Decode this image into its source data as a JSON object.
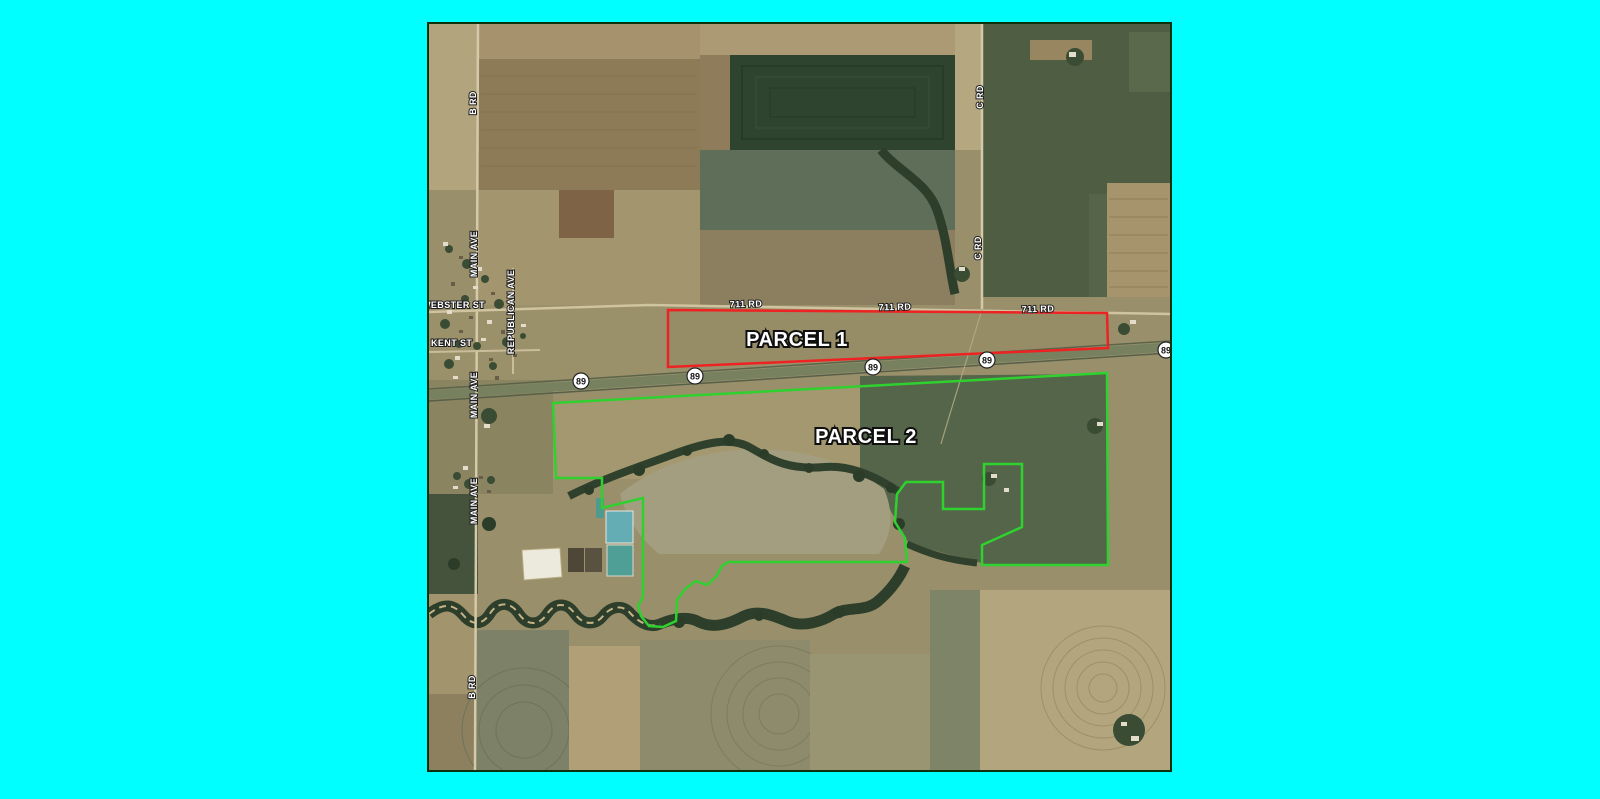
{
  "page": {
    "background_color": "#00ffff"
  },
  "map": {
    "border_color": "#0d300d",
    "parcels": [
      {
        "label": "PARCEL 1",
        "outline_color": "#ee2222"
      },
      {
        "label": "PARCEL 2",
        "outline_color": "#2fd12f"
      }
    ],
    "shields": [
      {
        "number": "89"
      },
      {
        "number": "89"
      },
      {
        "number": "89"
      },
      {
        "number": "89"
      },
      {
        "number": "89"
      }
    ],
    "road_labels": [
      {
        "text": "B RD"
      },
      {
        "text": "MAIN AVE"
      },
      {
        "text": "WEBSTER ST"
      },
      {
        "text": "REPUBLICAN AVE"
      },
      {
        "text": "KENT ST"
      },
      {
        "text": "MAIN AVE"
      },
      {
        "text": "MAIN AVE"
      },
      {
        "text": "B RD"
      },
      {
        "text": "C RD"
      },
      {
        "text": "C RD"
      },
      {
        "text": "711 RD"
      },
      {
        "text": "711 RD"
      },
      {
        "text": "711 RD"
      }
    ]
  }
}
